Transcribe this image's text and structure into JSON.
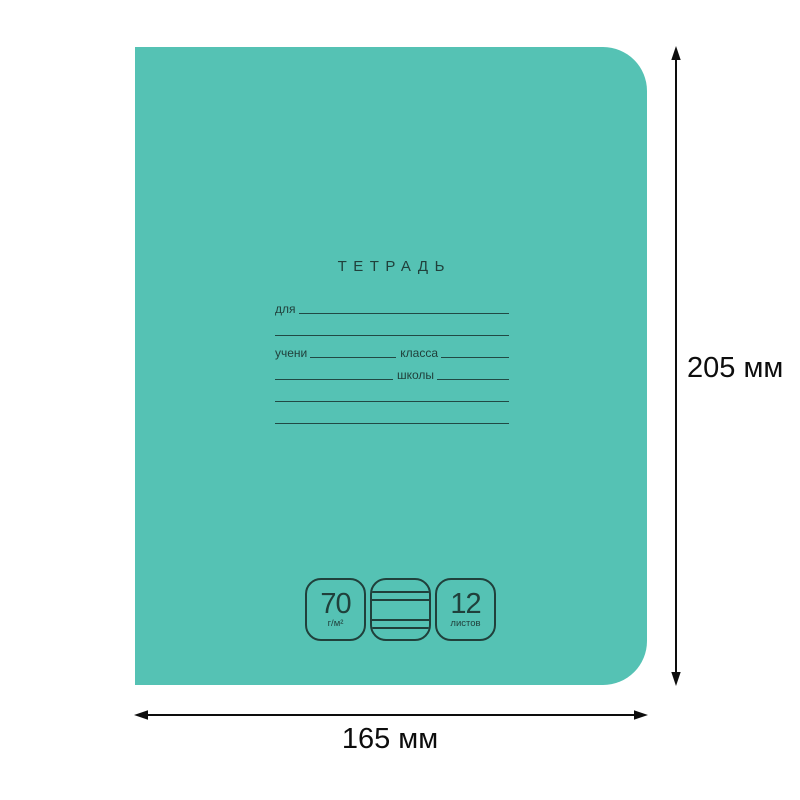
{
  "notebook": {
    "title": "ТЕТРАДЬ",
    "cover_color": "#55c2b4",
    "ink_color": "#20403b",
    "form": {
      "for_label": "для",
      "pupil_label": "учени",
      "class_label": "класса",
      "school_label": "школы"
    },
    "badges": {
      "density_value": "70",
      "density_unit": "г/м²",
      "ruling_icon": "lined-paper-icon",
      "sheets_value": "12",
      "sheets_unit": "листов"
    }
  },
  "dimensions": {
    "height_label": "205 мм",
    "width_label": "165 мм",
    "arrow_color": "#0d0d0d"
  }
}
